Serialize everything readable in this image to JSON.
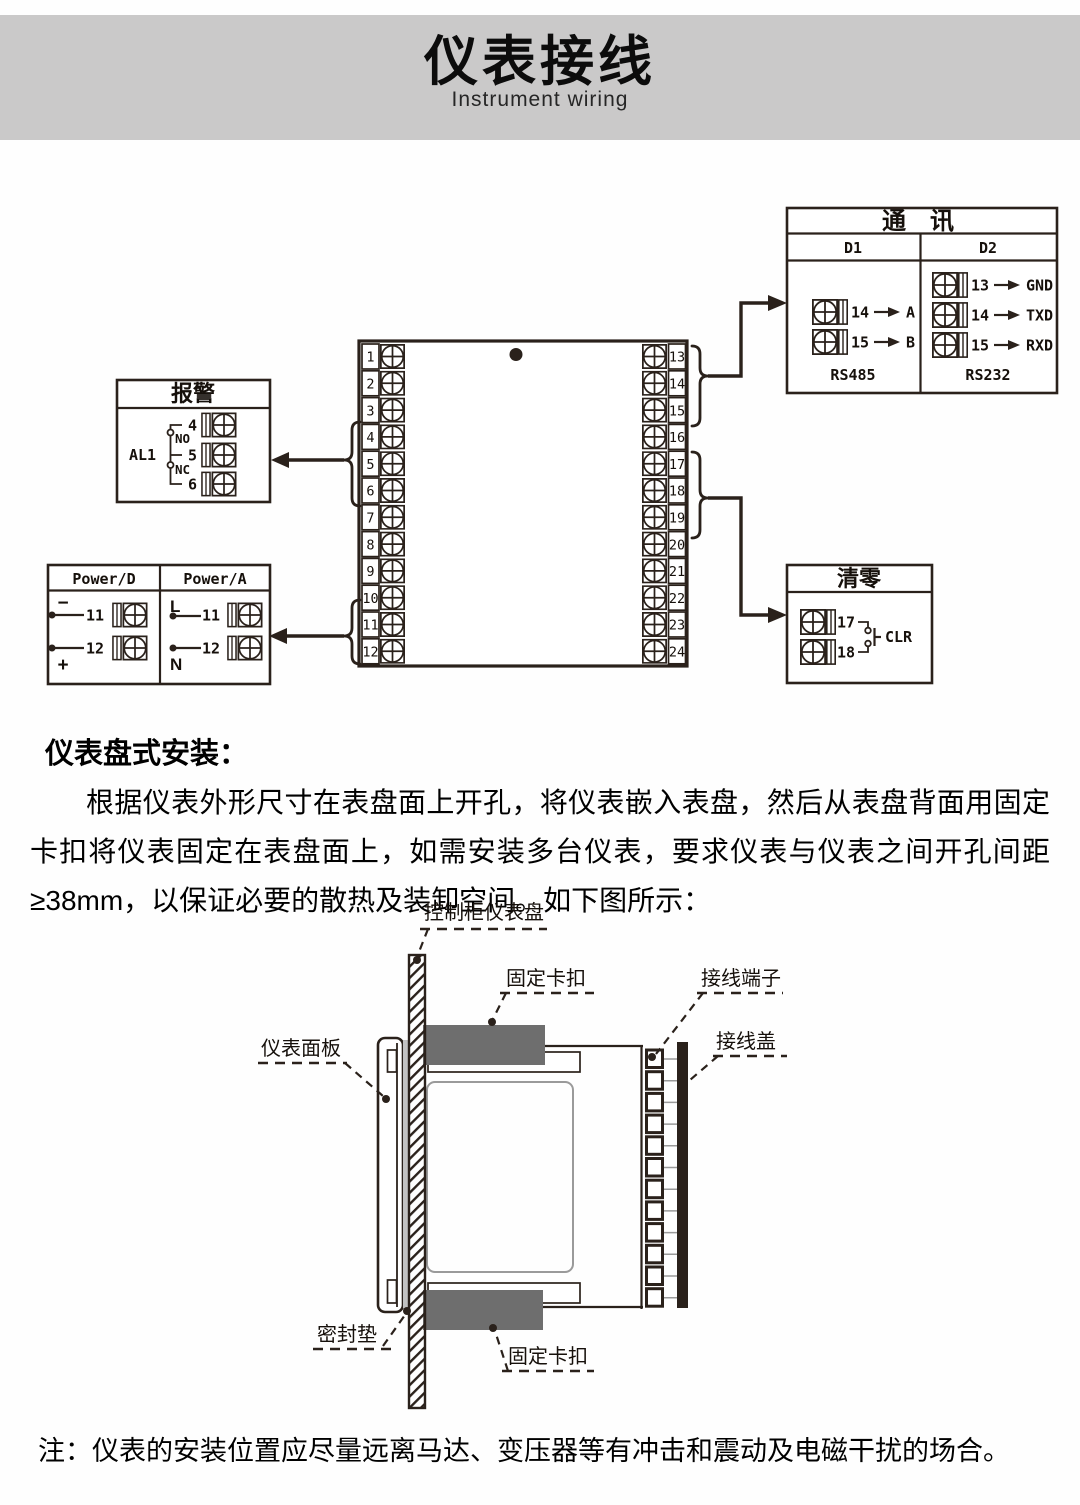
{
  "header": {
    "title": "仪表接线",
    "subtitle": "Instrument wiring"
  },
  "wiring": {
    "comm": {
      "title": "通　讯",
      "d1_label": "D1",
      "d2_label": "D2",
      "d1_rows": [
        {
          "num": "14",
          "target": "A"
        },
        {
          "num": "15",
          "target": "B"
        }
      ],
      "d2_rows": [
        {
          "num": "13",
          "target": "GND"
        },
        {
          "num": "14",
          "target": "TXD"
        },
        {
          "num": "15",
          "target": "RXD"
        }
      ],
      "d1_bus": "RS485",
      "d2_bus": "RS232"
    },
    "alarm": {
      "title": "报警",
      "relay_label": "AL1",
      "no_label": "NO",
      "nc_label": "NC",
      "terminals": [
        "4",
        "5",
        "6"
      ]
    },
    "power": {
      "d_label": "Power/D",
      "a_label": "Power/A",
      "d_rows": [
        {
          "sign": "−",
          "num": "11"
        },
        {
          "sign": "+",
          "num": "12"
        }
      ],
      "a_rows": [
        {
          "sign": "L",
          "num": "11"
        },
        {
          "sign": "N",
          "num": "12"
        }
      ]
    },
    "clear": {
      "title": "清零",
      "terminals": [
        "17",
        "18"
      ],
      "switch_label": "CLR"
    },
    "block": {
      "left": [
        "1",
        "2",
        "3",
        "4",
        "5",
        "6",
        "7",
        "8",
        "9",
        "10",
        "11",
        "12"
      ],
      "right": [
        "13",
        "14",
        "15",
        "16",
        "17",
        "18",
        "19",
        "20",
        "21",
        "22",
        "23",
        "24"
      ]
    }
  },
  "install": {
    "heading": "仪表盘式安装：",
    "paragraph": "根据仪表外形尺寸在表盘面上开孔，将仪表嵌入表盘，然后从表盘背面用固定卡扣将仪表固定在表盘面上，如需安装多台仪表，要求仪表与仪表之间开孔间距≥38mm，以保证必要的散热及装卸空间。如下图所示：",
    "labels": {
      "panel": "控制柜仪表盘",
      "clip_top": "固定卡扣",
      "terminals": "接线端子",
      "cover": "接线盖",
      "faceplate": "仪表面板",
      "gasket": "密封垫",
      "clip_bottom": "固定卡扣"
    }
  },
  "note": "注：仪表的安装位置应尽量远离马达、变压器等有冲击和震动及电磁干扰的场合。",
  "colors": {
    "banner": "#cac9c9",
    "line": "#2a211b",
    "clip_gray": "#6e6e6e",
    "gasket_gray": "#c2c2c2"
  }
}
